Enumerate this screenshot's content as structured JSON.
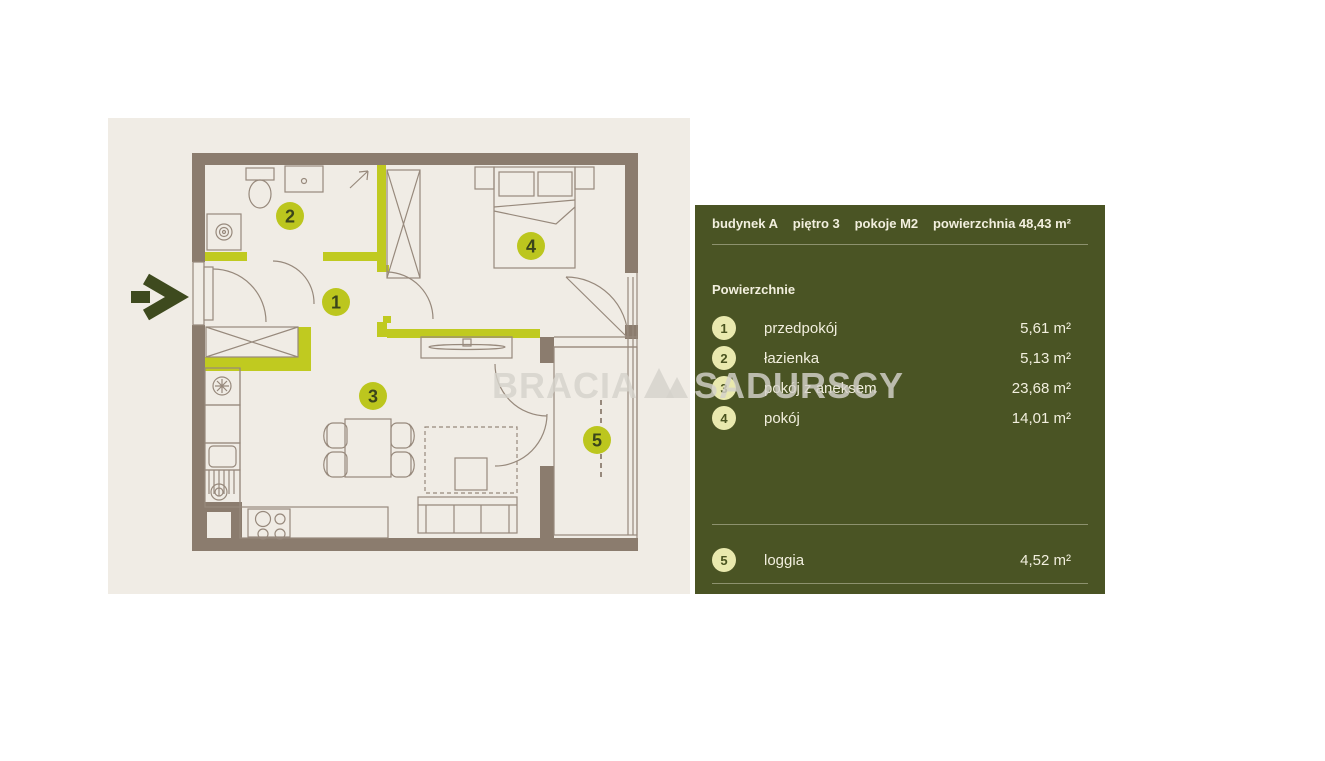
{
  "watermark": {
    "left": "BRACIA",
    "right": "SADURSCY"
  },
  "colors": {
    "panel_green": "#4a5424",
    "beige": "#f0ece5",
    "wall_brown": "#8b7c6e",
    "lime": "#c0ca20",
    "plan_badge_lime": "#bcc61e",
    "panel_badge_pale": "#e9e9ae",
    "cream_text": "#f2efde"
  },
  "plan": {
    "badges": [
      "1",
      "2",
      "3",
      "4",
      "5"
    ]
  },
  "panel": {
    "header": {
      "building": "budynek A",
      "floor": "piętro  3",
      "rooms": "pokoje  M2",
      "area": "powierzchnia 48,43 m²"
    },
    "section_title": "Powierzchnie",
    "rooms": [
      {
        "num": "1",
        "name": "przedpokój",
        "area": "5,61 m²"
      },
      {
        "num": "2",
        "name": "łazienka",
        "area": "5,13 m²"
      },
      {
        "num": "3",
        "name": "pokój z aneksem",
        "area": "23,68 m²"
      },
      {
        "num": "4",
        "name": "pokój",
        "area": "14,01 m²"
      }
    ],
    "loggia": {
      "num": "5",
      "name": "loggia",
      "area": "4,52 m²"
    }
  }
}
